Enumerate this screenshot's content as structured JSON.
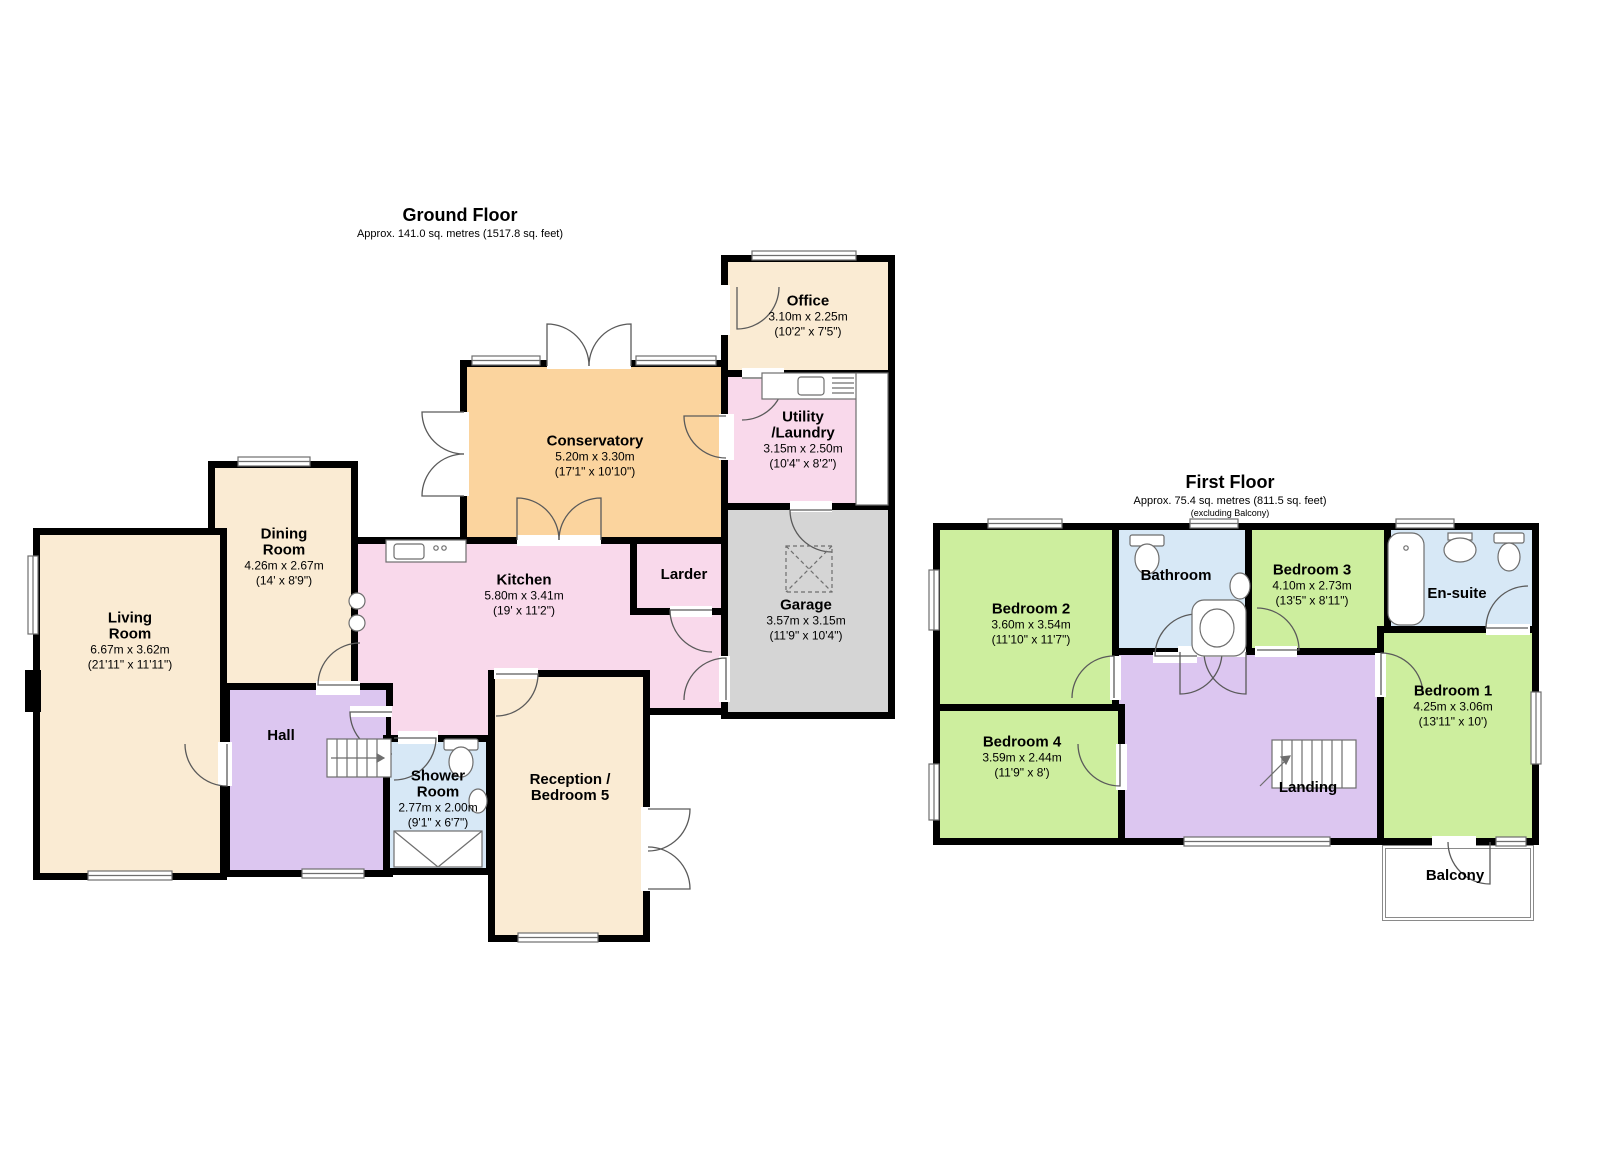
{
  "palette": {
    "wall": "#000000",
    "reception_cream": "#faebd3",
    "kitchen_pink": "#f9d9eb",
    "conservatory_orange": "#fbd49e",
    "garage_grey": "#d5d5d5",
    "hall_purple": "#dcc6f0",
    "bathroom_blue": "#d7e8f6",
    "bedroom_green": "#cdee9e"
  },
  "ground_floor": {
    "title": "Ground Floor",
    "subtitle": "Approx. 141.0 sq. metres (1517.8 sq. feet)",
    "rooms": {
      "living_room": {
        "name": "Living\nRoom",
        "metric": "6.67m x 3.62m",
        "imperial": "(21'11\" x 11'11\")"
      },
      "dining_room": {
        "name": "Dining\nRoom",
        "metric": "4.26m x 2.67m",
        "imperial": "(14' x 8'9\")"
      },
      "conservatory": {
        "name": "Conservatory",
        "metric": "5.20m x 3.30m",
        "imperial": "(17'1\" x 10'10\")"
      },
      "kitchen": {
        "name": "Kitchen",
        "metric": "5.80m x 3.41m",
        "imperial": "(19' x 11'2\")"
      },
      "larder": {
        "name": "Larder"
      },
      "office": {
        "name": "Office",
        "metric": "3.10m x 2.25m",
        "imperial": "(10'2\" x 7'5\")"
      },
      "utility": {
        "name": "Utility\n/Laundry",
        "metric": "3.15m x 2.50m",
        "imperial": "(10'4\" x 8'2\")"
      },
      "garage": {
        "name": "Garage",
        "metric": "3.57m x 3.15m",
        "imperial": "(11'9\" x 10'4\")"
      },
      "hall": {
        "name": "Hall"
      },
      "shower_room": {
        "name": "Shower\nRoom",
        "metric": "2.77m x 2.00m",
        "imperial": "(9'1\" x 6'7\")"
      },
      "reception": {
        "name": "Reception /\nBedroom 5"
      }
    }
  },
  "first_floor": {
    "title": "First Floor",
    "subtitle": "Approx. 75.4 sq. metres (811.5 sq. feet)",
    "note": "(excluding Balcony)",
    "rooms": {
      "bedroom_2": {
        "name": "Bedroom 2",
        "metric": "3.60m x 3.54m",
        "imperial": "(11'10\" x 11'7\")"
      },
      "bedroom_3": {
        "name": "Bedroom 3",
        "metric": "4.10m x 2.73m",
        "imperial": "(13'5\" x 8'11\")"
      },
      "bedroom_1": {
        "name": "Bedroom 1",
        "metric": "4.25m x 3.06m",
        "imperial": "(13'11\" x 10')"
      },
      "bedroom_4": {
        "name": "Bedroom 4",
        "metric": "3.59m x 2.44m",
        "imperial": "(11'9\" x 8')"
      },
      "bathroom": {
        "name": "Bathroom"
      },
      "ensuite": {
        "name": "En-suite"
      },
      "landing": {
        "name": "Landing"
      },
      "balcony": {
        "name": "Balcony"
      }
    }
  }
}
